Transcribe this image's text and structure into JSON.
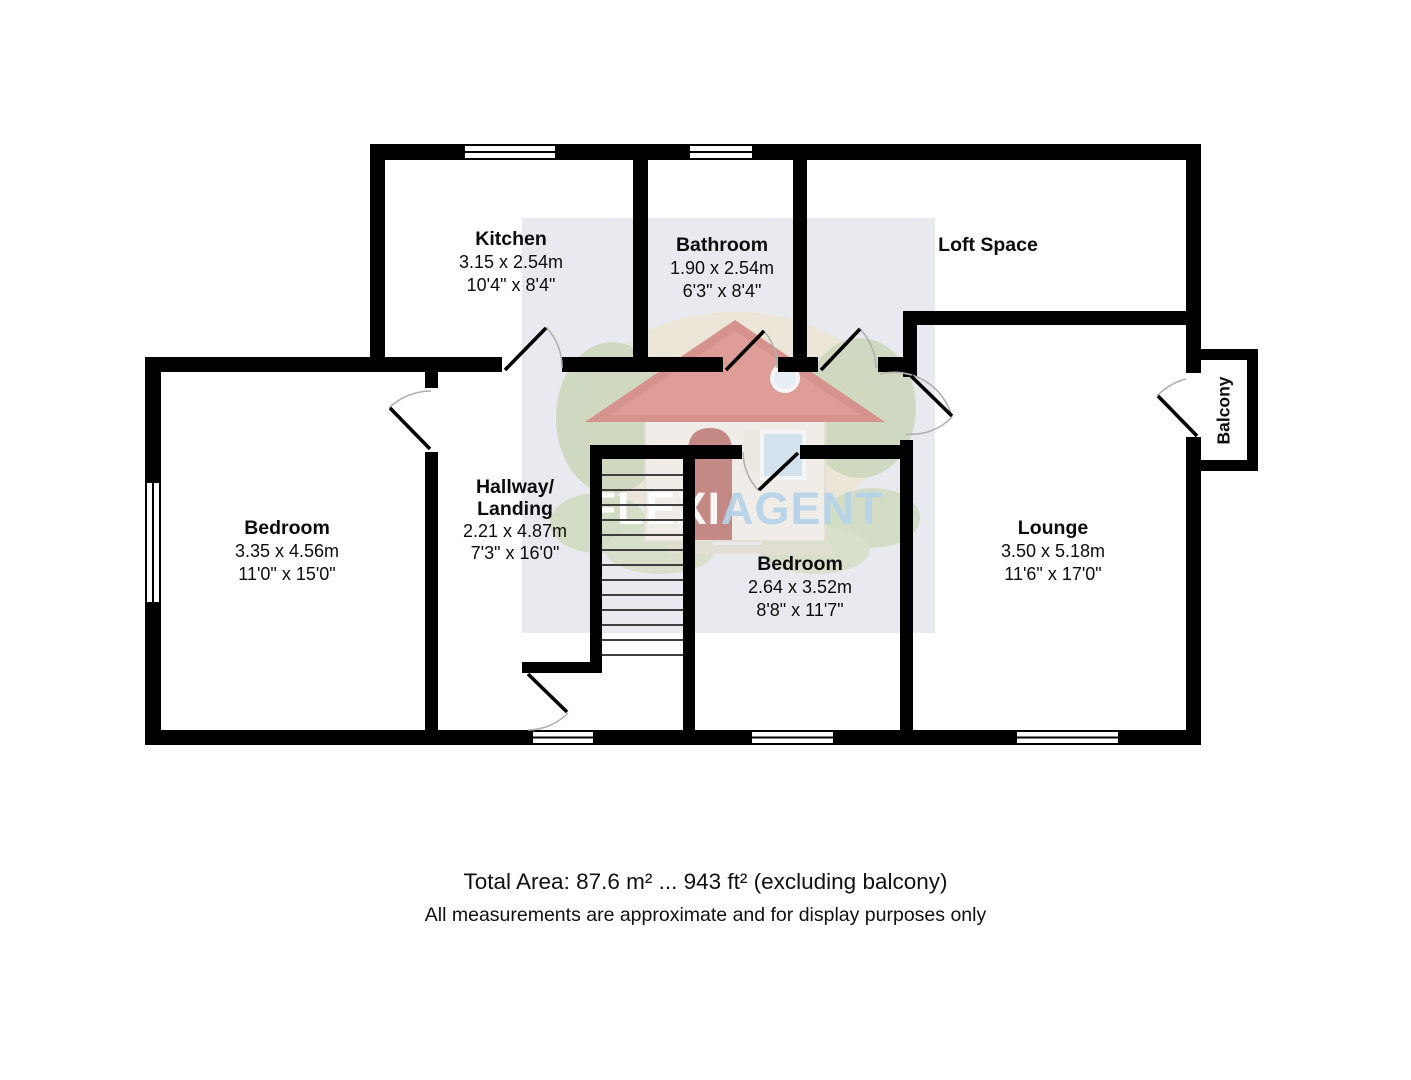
{
  "rooms": {
    "kitchen": {
      "name": "Kitchen",
      "dim_m": "3.15 x 2.54m",
      "dim_ft": "10'4\" x 8'4\""
    },
    "bathroom": {
      "name": "Bathroom",
      "dim_m": "1.90 x 2.54m",
      "dim_ft": "6'3\" x 8'4\""
    },
    "loft": {
      "name": "Loft Space"
    },
    "bedroom1": {
      "name": "Bedroom",
      "dim_m": "3.35 x 4.56m",
      "dim_ft": "11'0\" x 15'0\""
    },
    "hallway": {
      "name_line1": "Hallway/",
      "name_line2": "Landing",
      "dim_m": "2.21 x 4.87m",
      "dim_ft": "7'3\" x 16'0\""
    },
    "bedroom2": {
      "name": "Bedroom",
      "dim_m": "2.64 x 3.52m",
      "dim_ft": "8'8\" x 11'7\""
    },
    "lounge": {
      "name": "Lounge",
      "dim_m": "3.50 x 5.18m",
      "dim_ft": "11'6\" x 17'0\""
    },
    "balcony": {
      "name": "Balcony"
    }
  },
  "watermark": {
    "brand_left": "FLEXI",
    "brand_right": "AGENT"
  },
  "footer": {
    "total_area": "Total Area: 87.6 m² ... 943 ft² (excluding balcony)",
    "disclaimer": "All measurements are approximate and for display purposes only"
  },
  "colors": {
    "wall": "#000000",
    "watermark_box": "#e8eaef",
    "door_arc": "#b0b0b0"
  }
}
